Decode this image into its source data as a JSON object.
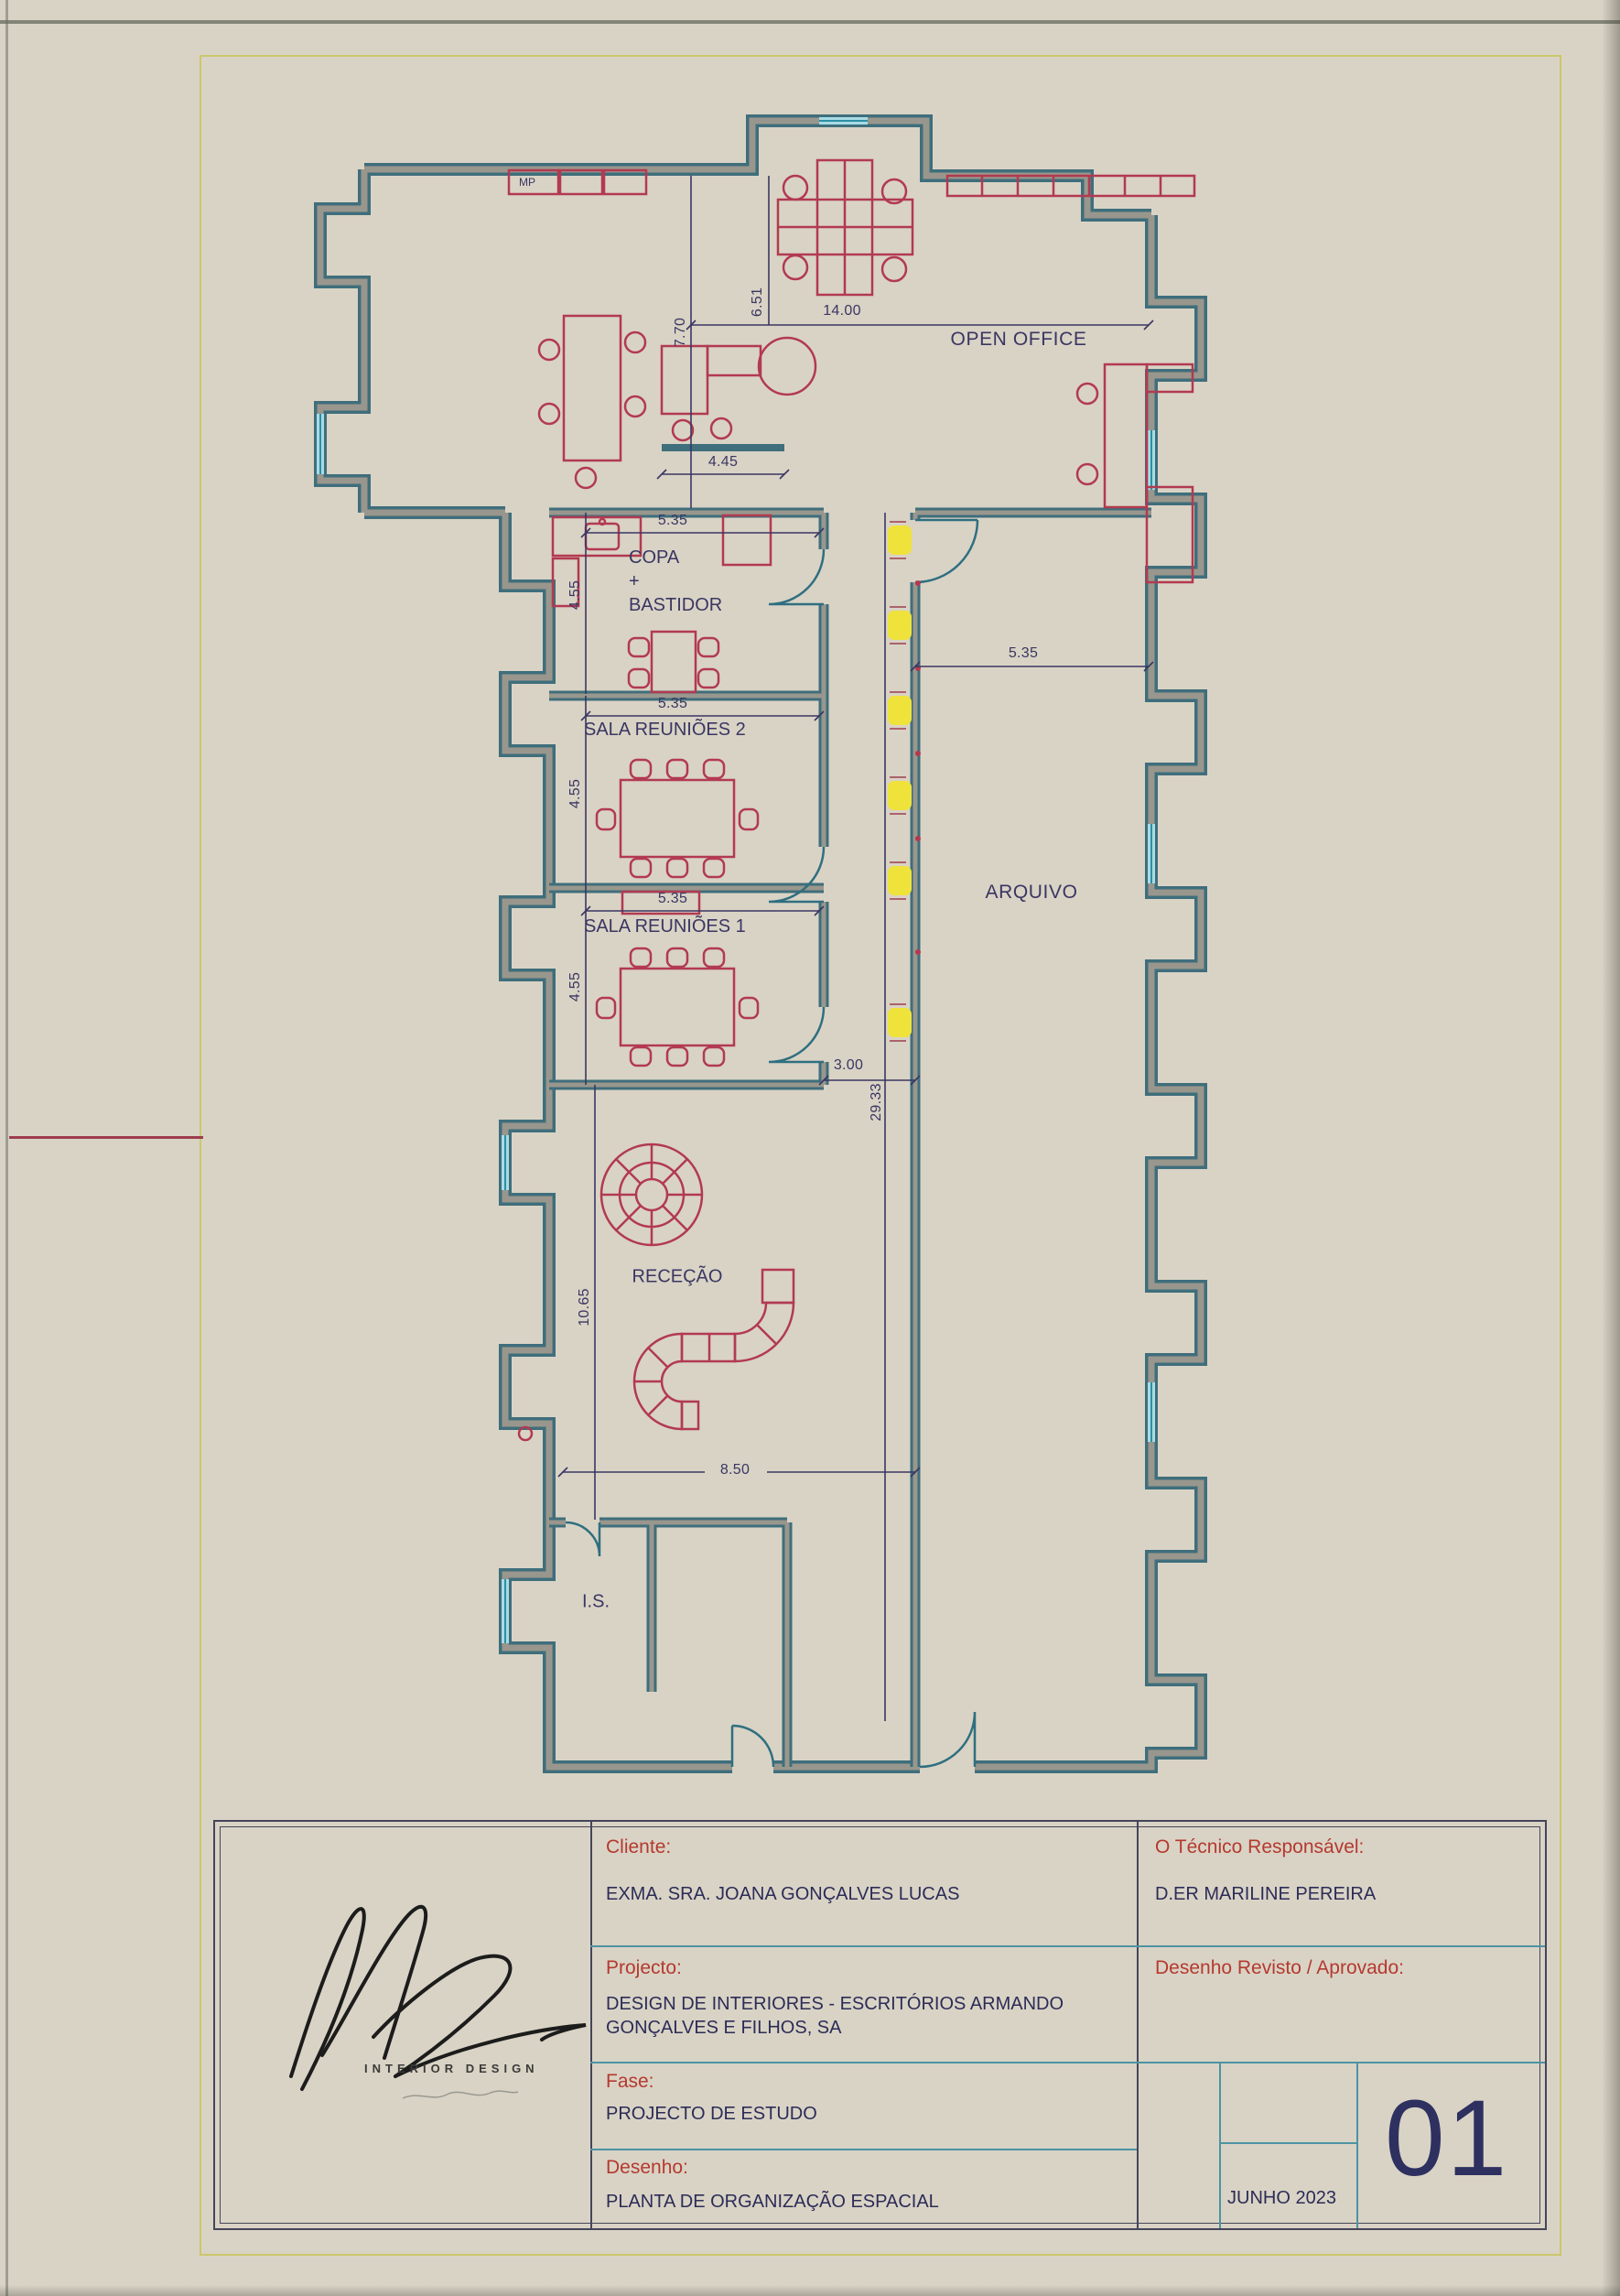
{
  "page": {
    "sheet_color": "#d9d3c5",
    "border_yellow": "#cbc76b",
    "margin_line_red": "#9e3c4e"
  },
  "plan": {
    "colors": {
      "wall_teal": "#3f6e7c",
      "wall_gray": "#99978d",
      "window_blue": "#a8dbe4",
      "furniture_red": "#b23a50",
      "dim_navy": "#3a3663",
      "fixture_yellow": "#efe23a"
    },
    "labels": {
      "open_office": "OPEN OFFICE",
      "mp": "MP",
      "copa_line1": "COPA",
      "copa_line2": "+",
      "copa_line3": "BASTIDOR",
      "sala2": "SALA REUNIÕES 2",
      "sala1": "SALA REUNIÕES 1",
      "arquivo": "ARQUIVO",
      "rececao": "RECEÇÃO",
      "is": "I.S."
    },
    "dims": {
      "open_width": "14.00",
      "open_depth": "6.51",
      "open_left_depth": "7.70",
      "screen_width": "4.45",
      "copa_width": "5.35",
      "copa_depth": "4.55",
      "sala2_width": "5.35",
      "sala2_depth": "4.55",
      "sala1_width": "5.35",
      "sala1_depth": "4.55",
      "arquivo_width": "5.35",
      "corridor_width": "3.00",
      "corridor_length": "29.33",
      "rececao_depth": "10.65",
      "rececao_width": "8.50"
    }
  },
  "title_block": {
    "cliente_label": "Cliente:",
    "cliente_value": "EXMA. SRA. JOANA GONÇALVES LUCAS",
    "projecto_label": "Projecto:",
    "projecto_value": "DESIGN DE INTERIORES - ESCRITÓRIOS ARMANDO\nGONÇALVES E FILHOS, SA",
    "fase_label": "Fase:",
    "fase_value": "PROJECTO DE ESTUDO",
    "desenho_label": "Desenho:",
    "desenho_value": "PLANTA DE ORGANIZAÇÃO ESPACIAL",
    "tecnico_label": "O Técnico Responsável:",
    "tecnico_value": "D.ER MARILINE PEREIRA",
    "revisto_label": "Desenho Revisto / Aprovado:",
    "date": "JUNHO 2023",
    "sheet_number": "01"
  },
  "logo": {
    "subtitle": "INTERIOR DESIGN"
  }
}
